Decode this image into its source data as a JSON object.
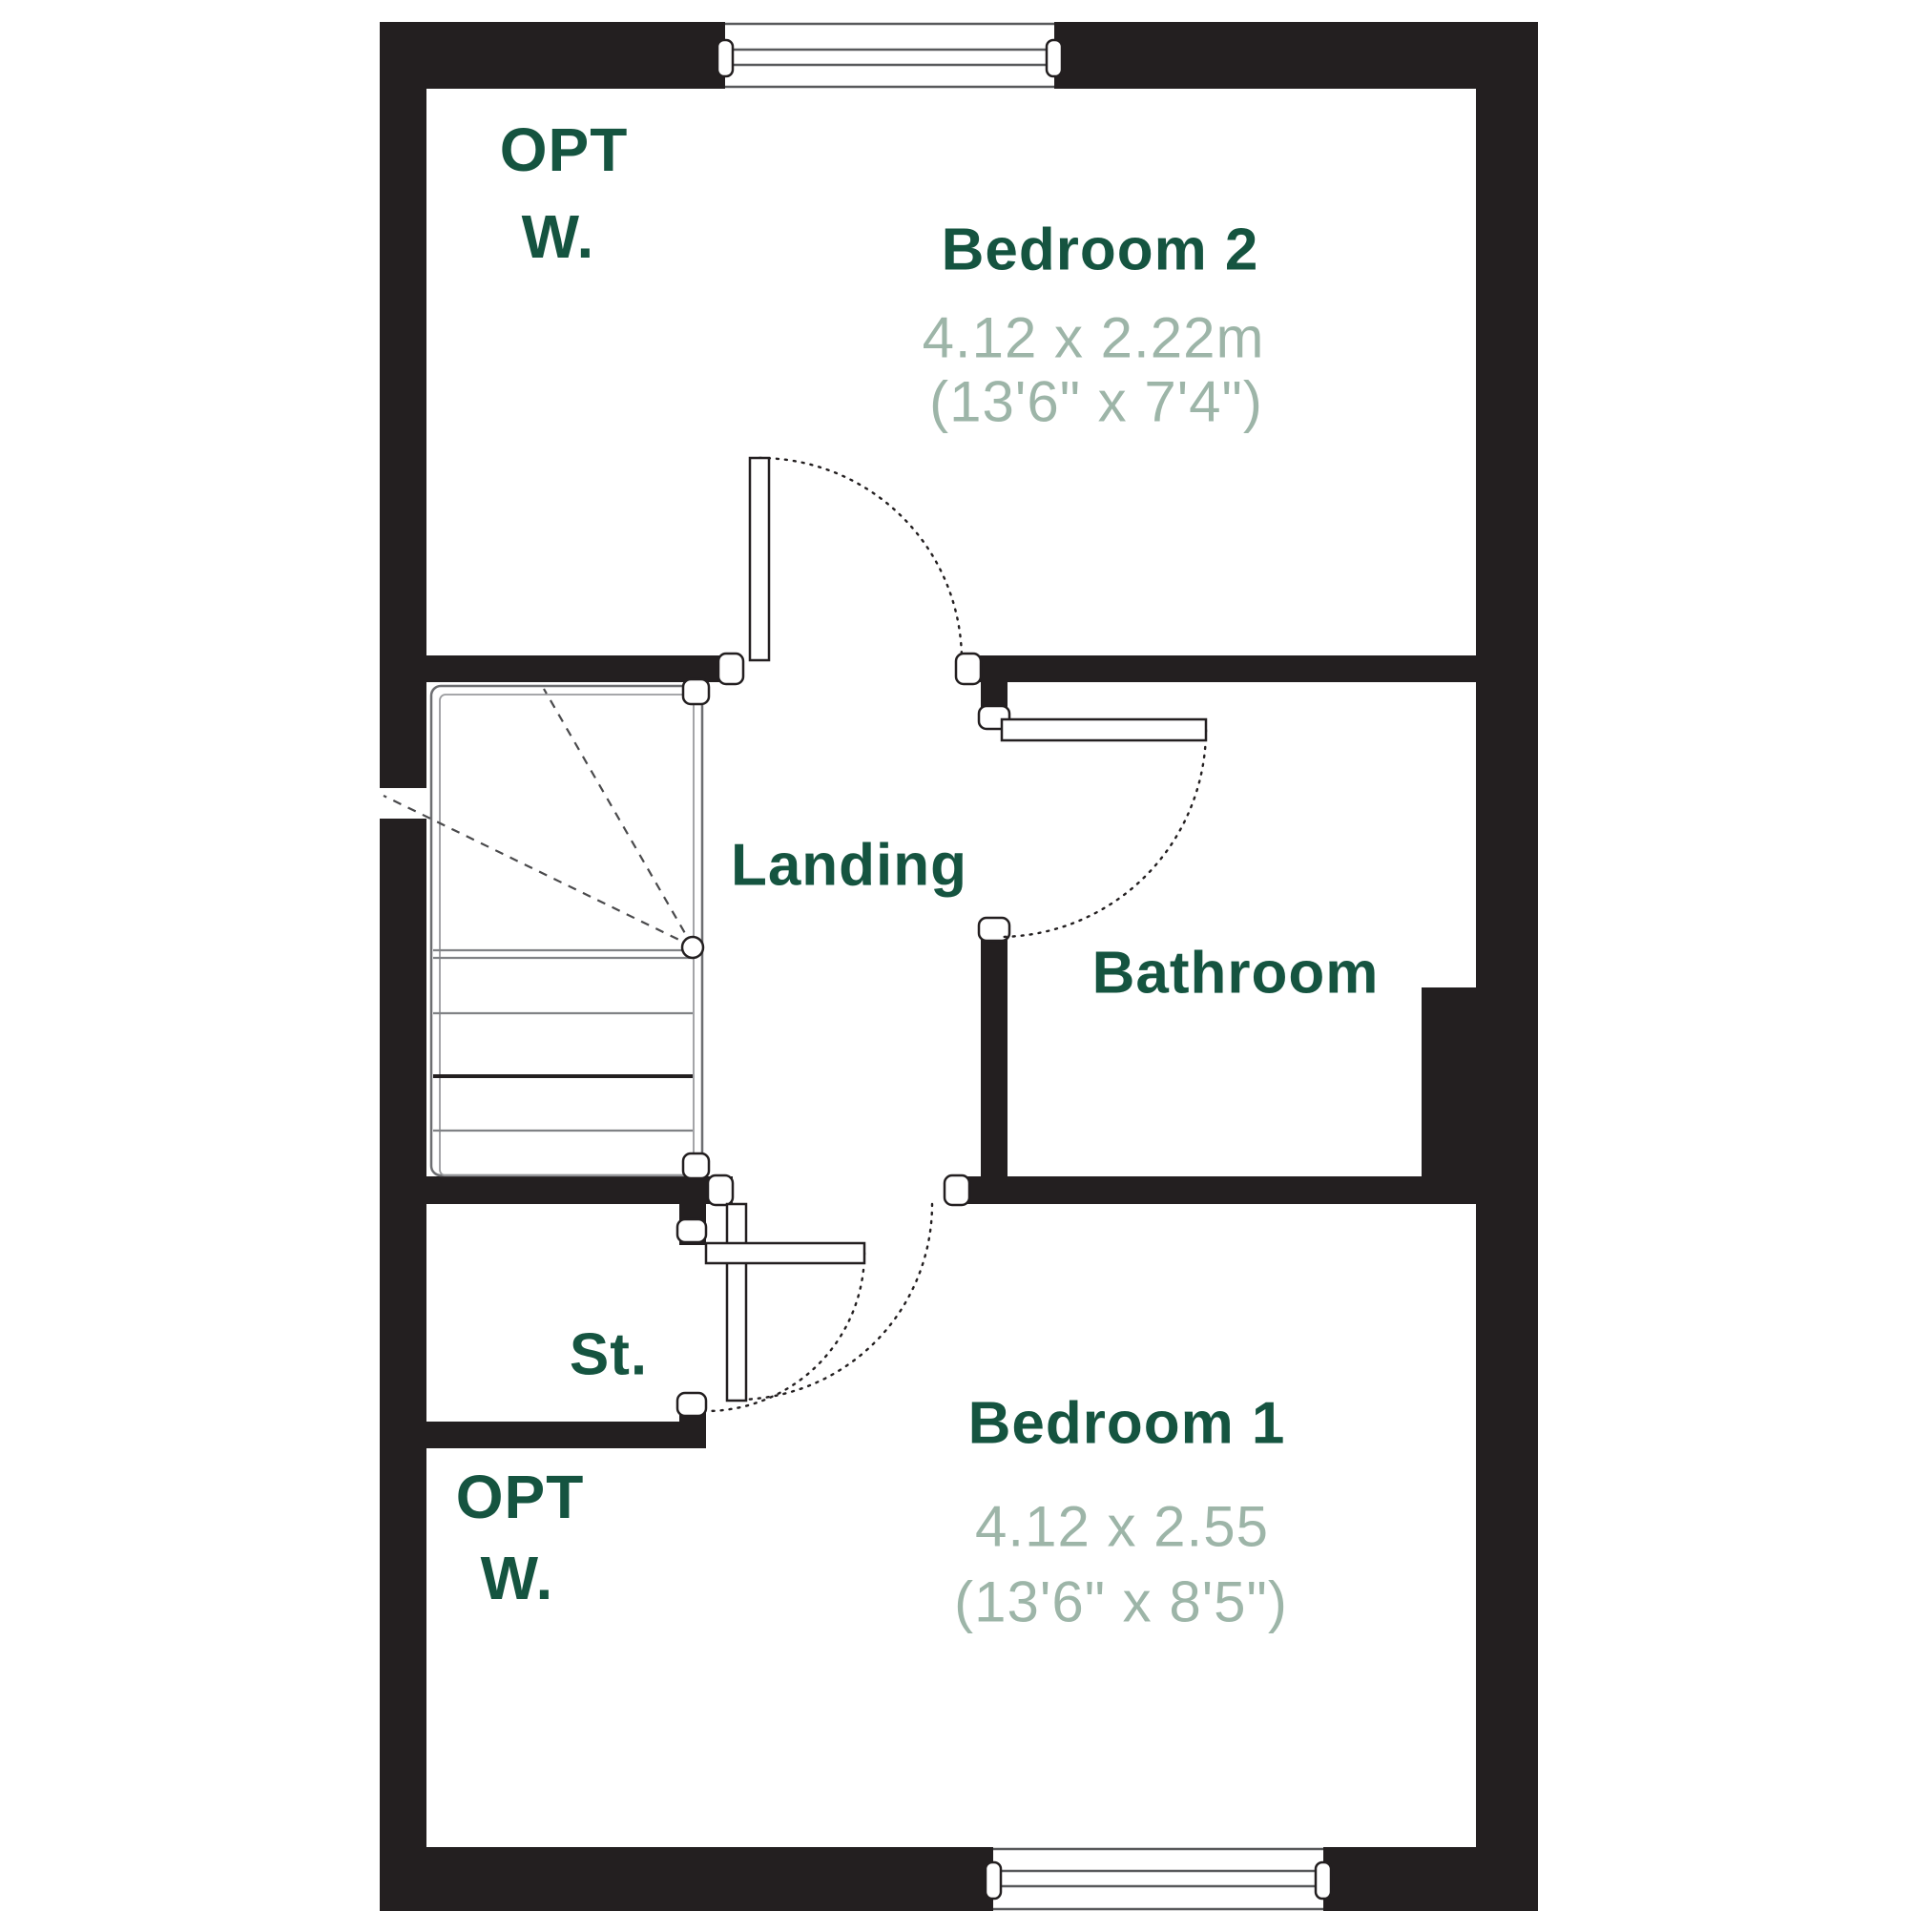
{
  "colors": {
    "wall": "#231f20",
    "room_label": "#155440",
    "dimension_text": "#9db5a8",
    "detail_line": "#58595b",
    "stair_line": "#808285",
    "background": "#ffffff"
  },
  "plan": {
    "bedroom2": {
      "name": "Bedroom 2",
      "metric": "4.12 x 2.22m",
      "imperial": "(13'6\" x 7'4\")"
    },
    "landing": {
      "name": "Landing"
    },
    "bathroom": {
      "name": "Bathroom"
    },
    "store": {
      "name": "St."
    },
    "bedroom1": {
      "name": "Bedroom 1",
      "metric": "4.12 x 2.55",
      "imperial": "(13'6\" x 8'5\")"
    },
    "opt_wardrobe_top": {
      "line1": "OPT",
      "line2": "W."
    },
    "opt_wardrobe_bottom": {
      "line1": "OPT",
      "line2": "W."
    }
  }
}
